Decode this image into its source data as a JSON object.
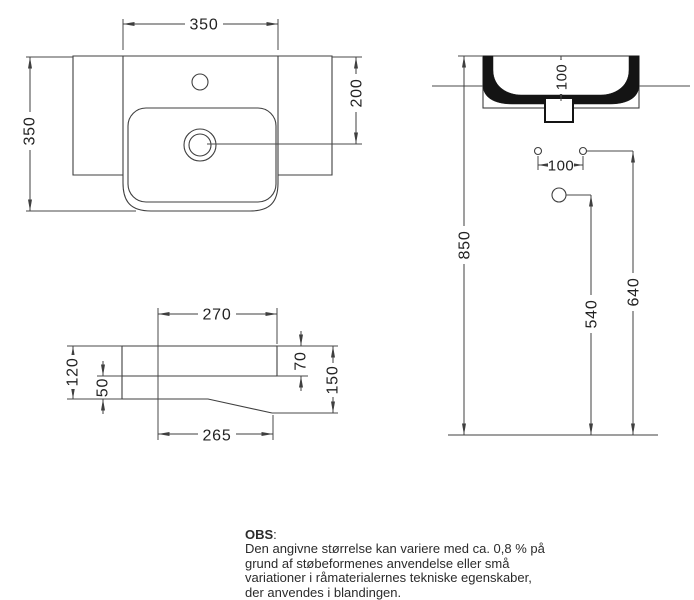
{
  "dimensions": {
    "top_view": {
      "width": "350",
      "depth": "350",
      "drain_from_rear": "200"
    },
    "section_view": {
      "bowl_depth": "100",
      "bolt_spacing": "100",
      "rim_height": "850",
      "bolt_height": "640",
      "drain_height": "540"
    },
    "side_profile": {
      "top_depth": "270",
      "front_height": "120",
      "bottom_front_height": "50",
      "rim_thickness": "70",
      "total_height": "150",
      "bottom_depth": "265"
    }
  },
  "note": {
    "title": "OBS",
    "colon": ":",
    "lines": [
      "Den angivne størrelse kan variere med ca. 0,8 % på",
      "grund af støbeformenes anvendelse eller små",
      "variationer i råmaterialernes tekniske egenskaber,",
      "der anvendes i blandingen."
    ]
  }
}
